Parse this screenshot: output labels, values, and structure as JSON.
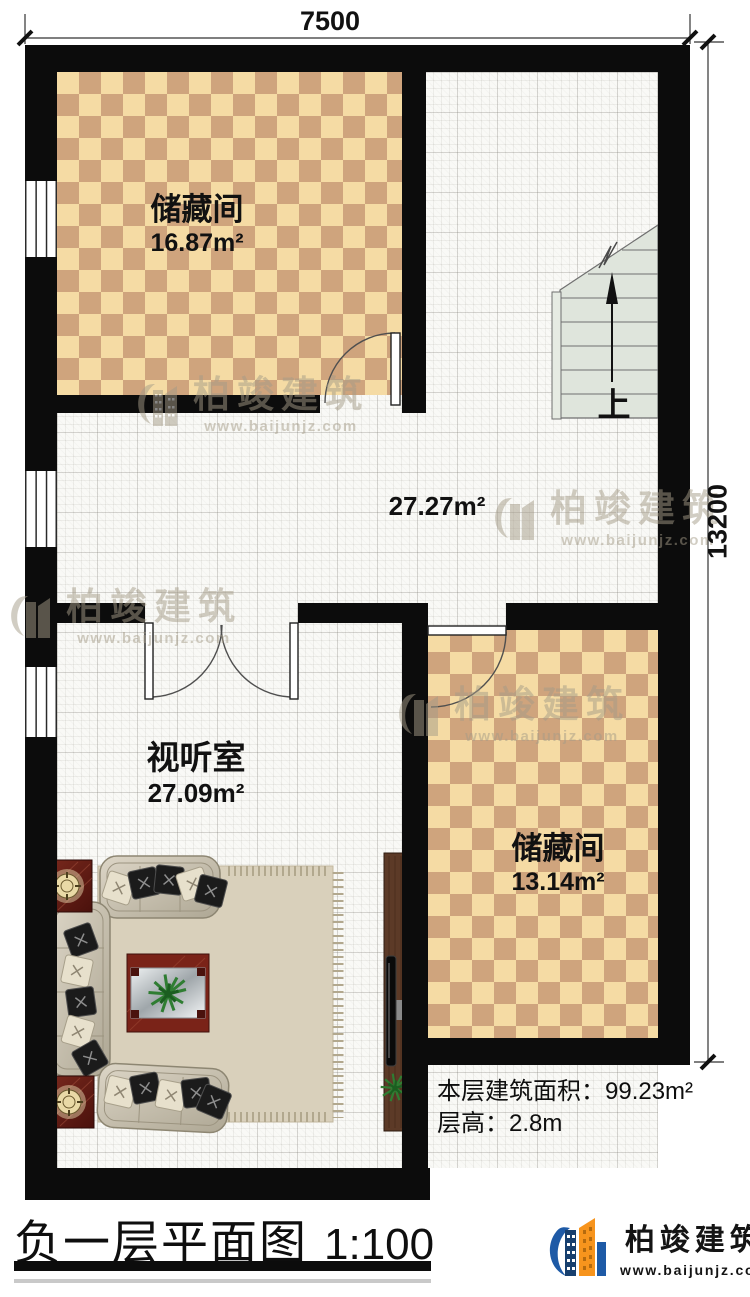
{
  "plan": {
    "dimensions": {
      "width_mm": "7500",
      "height_mm": "13200"
    },
    "rooms": {
      "storage1": {
        "name": "储藏间",
        "area": "16.87m²"
      },
      "hall": {
        "area": "27.27m²"
      },
      "av": {
        "name": "视听室",
        "area": "27.09m²"
      },
      "storage2": {
        "name": "储藏间",
        "area": "13.14m²"
      }
    },
    "stairs_label": "上"
  },
  "notes": {
    "area_line": "本层建筑面积：99.23m²",
    "height_line": "层高：2.8m"
  },
  "title_block": {
    "title": "负一层平面图",
    "scale": "1:100"
  },
  "brand": {
    "name": "柏竣建筑",
    "website": "www.baijunjz.com"
  },
  "watermark": {
    "name": "柏竣建筑",
    "website": "www.baijunjz.com"
  },
  "colors": {
    "wall": "#0c0c0c",
    "checker_light": "#f5dba4",
    "checker_dark": "#cfa47d",
    "stairs": "#dfe5dc",
    "logo_blue": "#1e5aa6",
    "logo_orange": "#f7941d"
  }
}
